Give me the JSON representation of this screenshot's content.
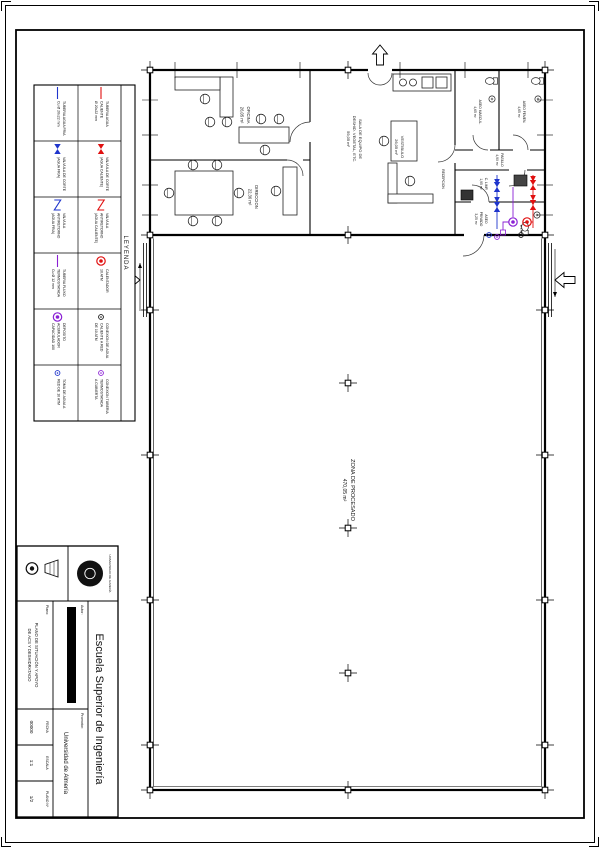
{
  "colors": {
    "cold_water": "#1f35cc",
    "hot_water": "#e01010",
    "thermo": "#8a1fd4",
    "ink": "#111111"
  },
  "legend": {
    "title": "LEYENDA",
    "row1": [
      {
        "symbol": "hot-pipe",
        "l1": "TUBERIA AGUA",
        "l2": "CALIENTE",
        "l3": "Ø 20x22 mm"
      },
      {
        "symbol": "hot-valve",
        "l1": "VALVULA DE CORTE",
        "l2": "(AGUA CALIENTE)",
        "l3": ""
      },
      {
        "symbol": "hot-check-valve",
        "l1": "VALVULA",
        "l2": "ANTIRETORNO",
        "l3": "(AGUA CALIENTE)"
      },
      {
        "symbol": "heater",
        "l1": "CALENTADOR",
        "l2": "10 ATM",
        "l3": ""
      },
      {
        "symbol": "hot-connection",
        "l1": "CONEXION DE AGUA",
        "l2": "CALIENTE A RED",
        "l3": "DE 10 ATM"
      },
      {
        "symbol": "thermo-connection",
        "l1": "CONEXION TUBERIA",
        "l2": "TERMOSTATADA",
        "l3": "A CUBIERTA"
      }
    ],
    "row2": [
      {
        "symbol": "cold-pipe",
        "l1": "TUBERIA AGUA FRIA",
        "l2": "Cu Ø 20x22 mm",
        "l3": ""
      },
      {
        "symbol": "cold-valve",
        "l1": "VALVULA DE CORTE",
        "l2": "(AGUA FRIA)",
        "l3": ""
      },
      {
        "symbol": "cold-check-valve",
        "l1": "VALVULA",
        "l2": "ANTIRETORNO",
        "l3": "(AGUA FRIA)"
      },
      {
        "symbol": "thermo-pipe",
        "l1": "TUBERIA FLUXO",
        "l2": "TERMOSTATADA",
        "l3": "Cu Ø 12 mm"
      },
      {
        "symbol": "tank",
        "l1": "DEPOSITO",
        "l2": "ACUMULADOR",
        "l3": "CAPACIDAD 100"
      },
      {
        "symbol": "cold-connection",
        "l1": "TOMA DE AGUA A",
        "l2": "RED DE 10 ATM",
        "l3": ""
      }
    ]
  },
  "rooms": {
    "oficina": {
      "name": "OFICINA",
      "area": "26,05 m²"
    },
    "direccion": {
      "name": "DIRECCION",
      "area": "22,36 m²"
    },
    "sala": {
      "l1": "SALA DE EQUIPO DE",
      "l2": "DESHID. VEGETAL, ETC.",
      "area": "59,05 m²"
    },
    "vestibulo": {
      "name": "VESTIBULO",
      "area": "26,05 m²"
    },
    "aseo_fem": {
      "name": "ASEO FEMEN.",
      "area": "4,65 m²"
    },
    "aseo_masc": {
      "name": "ASEO MASCUL.",
      "area": "4,65 m²"
    },
    "pasillo": {
      "name": "PASILLO",
      "area": "4,90 m²"
    },
    "c_limp": {
      "name": "C. LIMP.",
      "area": "1,95 m²"
    },
    "aseo_priv": {
      "name": "ASEO",
      "name2": "PRIVADO",
      "area": "3,25 m²"
    },
    "recepcion": {
      "name": "RECEPCION"
    },
    "nave": {
      "name": "ZONA DE PROCESADO",
      "area": "470,05 m²"
    }
  },
  "title_block": {
    "school": "Escuela Superior de Ingeniería",
    "logo_caption": "UNIVERSIDAD DE ALMERÍA",
    "autor_label": "Autor:",
    "promotor_label": "Promotor:",
    "promotor": "Universidad de Almería",
    "plano_label": "Plano:",
    "plano_l1": "PLANO DE SITUACIÓN Y APOYO",
    "plano_l2": "DE ACS Y DESHIDRATADO",
    "fecha_label": "FECHA",
    "fecha": "00000",
    "escala_label": "ESCALA",
    "escala": "1:1",
    "num_label": "PLANO Nº",
    "num": "1/2"
  }
}
